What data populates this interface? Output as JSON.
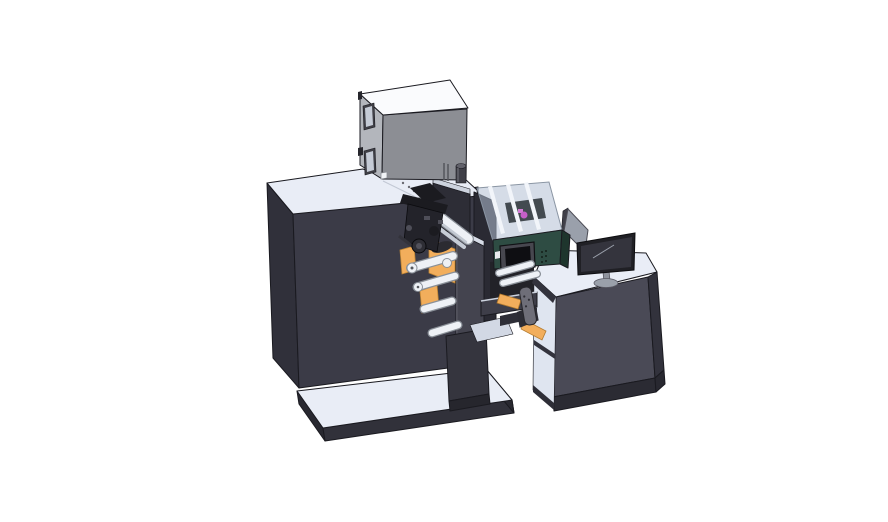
{
  "scene": {
    "title": "Isometric 3D CAD rendering of an industrial label printing and rewinding machine with an operator desk and monitor",
    "background": "#ffffff"
  },
  "colors": {
    "surface_top": "#e9edf6",
    "cabinet_front": "#3b3b47",
    "cabinet_side": "#30303a",
    "platform_front": "#31313a",
    "platform_side": "#282830",
    "tower_top": "#cdd3de",
    "tower_front": "#2d2d36",
    "midframe": "#2a2a33",
    "underbody": "#222228",
    "box_top": "#fafbfd",
    "box_side": "#b3b6bc",
    "box_front": "#8c8e94",
    "box_inset_frame": "#3f3f46",
    "box_inset": "#c5cbd6",
    "box_nub": "#26262c",
    "box_square": "#f2f4f7",
    "cylinder": "#3f3f47",
    "cylinder_top": "#61616a",
    "cylinder_hl": "#6d6d76",
    "desk_front": "#4a4a56",
    "desk_side": "#32323c",
    "desk_plinth": "#2b2b33",
    "desk_interior": "#dfe5f0",
    "desk_frame": "#33333d",
    "desk_sill": "#2e2e37",
    "handle": "#6e6e78",
    "handle_dot": "#2e2e35",
    "bracket": "#2c2c34",
    "panel_gray": "#9aa0ab",
    "panel_edge": "#3f3f48",
    "monitor_bezel": "#202025",
    "monitor_screen": "#34343d",
    "monitor_reflect": "#9aa0ab",
    "monitor_stand": "#8f939d",
    "monitor_base": "#9aa0aa",
    "glass": "rgba(178,192,212,0.55)",
    "glass_rib": "#f2f5fa",
    "glass_machinery": "#434a50",
    "purple": "#c65fc8",
    "magenta": "#d27ad4",
    "green_front": "#2e4c43",
    "green_side": "#1e352d",
    "hmi_housing": "#47474f",
    "hmi_screen": "#0e0e12",
    "hmi_dot": "#142019",
    "sticker": "#e9eaee",
    "orange": "#f2ae5c",
    "orange_core": "#2b2b31",
    "roller_fill": "#eef1f6",
    "roller_edge": "#8a9098",
    "roller_shade": "#c3c9d2",
    "rail": "#c6ccd6",
    "plate_front": "#44444f",
    "plate_top": "#d7dce7",
    "plate_hl": "#6a6a75",
    "column": "#35353e",
    "column_dark": "#26262d",
    "wedge": "#d2d8e4",
    "beam": "#3e3e49",
    "beam_top": "#cdd3de",
    "ledge": "#2e2e37",
    "mech_dark": "#1b1b20",
    "mech_body": "#23232a",
    "mech_mid": "#2e2e35",
    "mech_hub": "#51515b",
    "mech_light": "#4e4e58",
    "mech_rod": "#33333b",
    "crease": "#c2c8d4",
    "dot": "#6a6a72"
  },
  "parts": [
    {
      "id": "base-platform",
      "label": "Base platform"
    },
    {
      "id": "main-cabinet",
      "label": "Main machine cabinet"
    },
    {
      "id": "feeder-box",
      "label": "Gray feeder box on top"
    },
    {
      "id": "exhaust-cylinder",
      "label": "Small cylinder on cabinet top"
    },
    {
      "id": "print-head-mechanism",
      "label": "Print head mechanism"
    },
    {
      "id": "media-rolls",
      "label": "Orange media rolls"
    },
    {
      "id": "guide-rollers",
      "label": "White guide rollers"
    },
    {
      "id": "web-plate",
      "label": "Vertical web guide plate"
    },
    {
      "id": "glass-enclosure",
      "label": "Transparent inspection enclosure"
    },
    {
      "id": "control-unit",
      "label": "Green control unit with touchscreen"
    },
    {
      "id": "divider-panel",
      "label": "Gray divider panel"
    },
    {
      "id": "monitor",
      "label": "Desktop monitor"
    },
    {
      "id": "operator-desk",
      "label": "Operator desk with open shelves"
    },
    {
      "id": "support-column",
      "label": "Central support column"
    },
    {
      "id": "connecting-beam",
      "label": "Connecting beam"
    },
    {
      "id": "handle",
      "label": "Side handle"
    }
  ]
}
